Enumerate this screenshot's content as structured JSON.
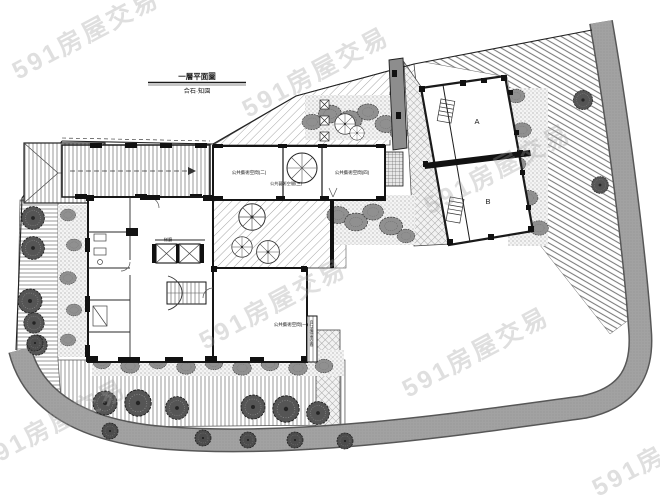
{
  "watermark": {
    "text": "591房屋交易",
    "color": "#c4c4c4"
  },
  "title_block": {
    "line1": "一層平面圖",
    "line2": "合石·知園"
  },
  "plan": {
    "units": {
      "unit_a": "A",
      "unit_b": "B"
    },
    "rooms": {
      "art_space_1": "公共藝術空間(一)",
      "art_space_2": "公共藝術空間(二)",
      "art_space_3": "公共藝術空間(三)",
      "art_space_4": "公共藝術空間(四)",
      "elevator_lobby": "梯廳",
      "bike_parking": "自行車停車空間"
    },
    "colors": {
      "linework": "#1c1c1c",
      "road_fill": "#a2a2a2",
      "road_edge": "#575757",
      "paving_hatch": "#a6a6a6",
      "shrub": "#909090",
      "tree_dark": "#4c4c4c",
      "wall_gray": "#8d8d8d"
    }
  }
}
